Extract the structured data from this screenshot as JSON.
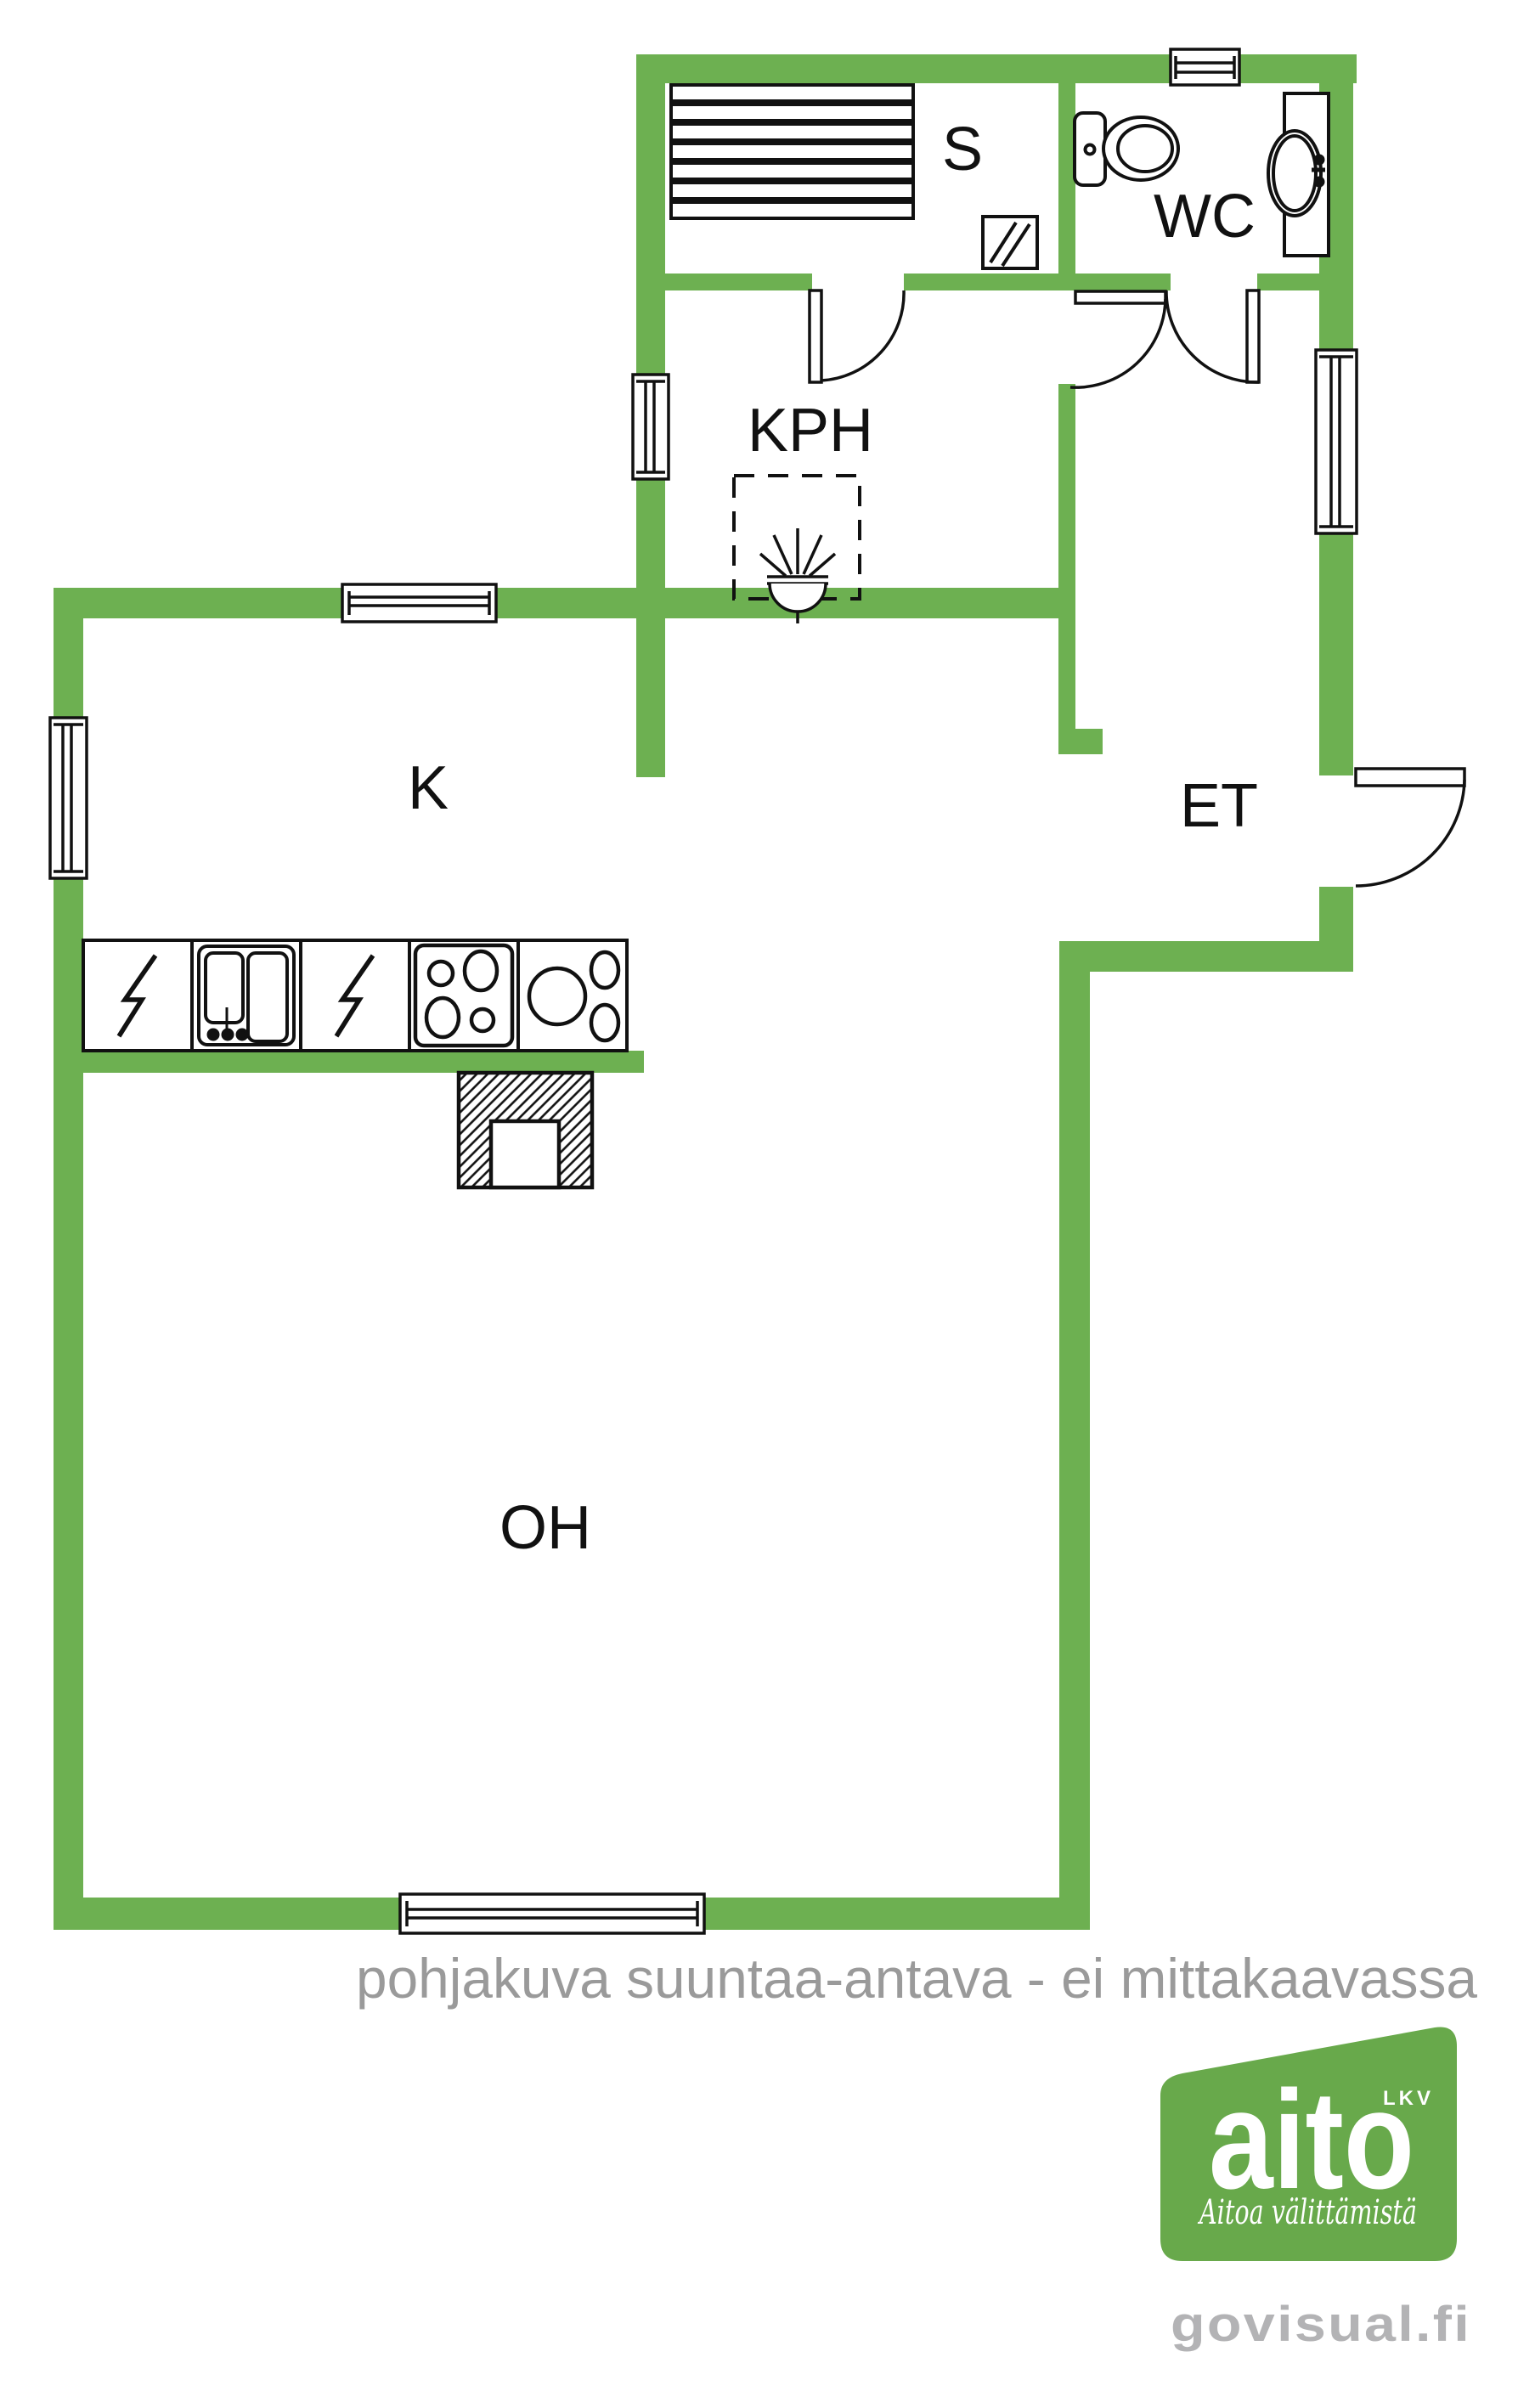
{
  "plan": {
    "title": "floor-plan",
    "rooms": [
      {
        "id": "sauna",
        "label": "S"
      },
      {
        "id": "wc",
        "label": "WC"
      },
      {
        "id": "bathroom",
        "label": "KPH"
      },
      {
        "id": "kitchen",
        "label": "K"
      },
      {
        "id": "entry",
        "label": "ET"
      },
      {
        "id": "living",
        "label": "OH"
      }
    ],
    "disclaimer": "pohjakuva suuntaa-antava - ei mittakaavassa",
    "colors": {
      "wall": "#6db051",
      "line": "#111111",
      "disclaimer_gray": "#9a9a9a",
      "watermark_gray": "#b3b3b5",
      "logo_green": "#68a94b",
      "logo_text": "#ffffff"
    }
  },
  "branding": {
    "logo_text": "aito",
    "logo_suffix": "LKV",
    "logo_tagline": "Aitoa välittämistä",
    "watermark": "govisual.fi"
  }
}
